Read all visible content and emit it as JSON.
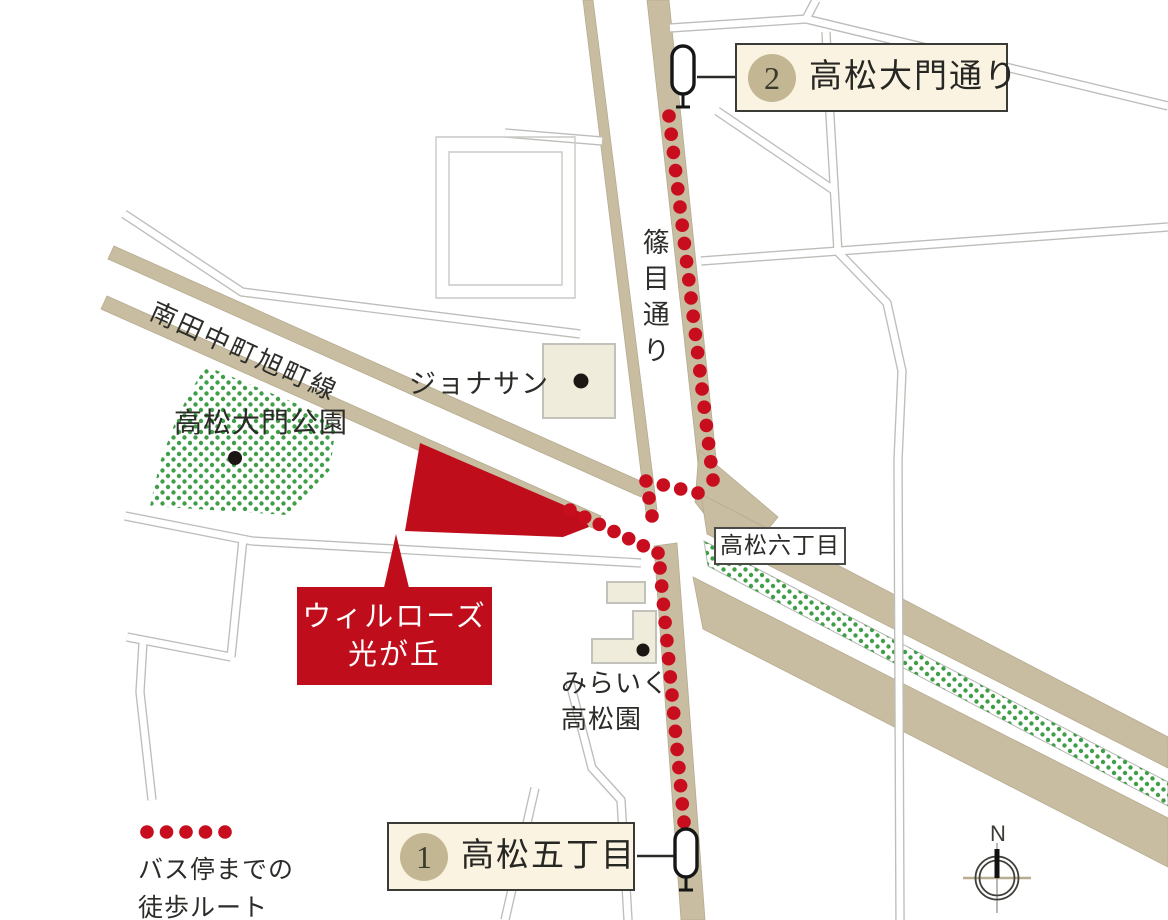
{
  "map_labels": {
    "shinome_street": "篠目通り",
    "minamitanaka_line": "南田中町旭町線",
    "park": "高松大門公園",
    "restaurant": "ジョナサン",
    "district": "高松六丁目",
    "nursery_line1": "みらいく",
    "nursery_line2": "高松園"
  },
  "property": {
    "line1": "ウィルローズ",
    "line2": "光が丘"
  },
  "bus_stops": [
    {
      "number": "1",
      "name": "高松五丁目"
    },
    {
      "number": "2",
      "name": "高松大門通り"
    }
  ],
  "legend": {
    "line1": "バス停までの",
    "line2": "徒歩ルート"
  },
  "compass": {
    "north": "N"
  },
  "colors": {
    "route_red": "#c80d1e",
    "property_red": "#bf0d1b",
    "road_tan": "#c8bda0",
    "green_dot": "#3f9e47",
    "box_cream": "#faf3e2",
    "circle_tan": "#c3b692",
    "building_cream": "#f0ecdc"
  }
}
